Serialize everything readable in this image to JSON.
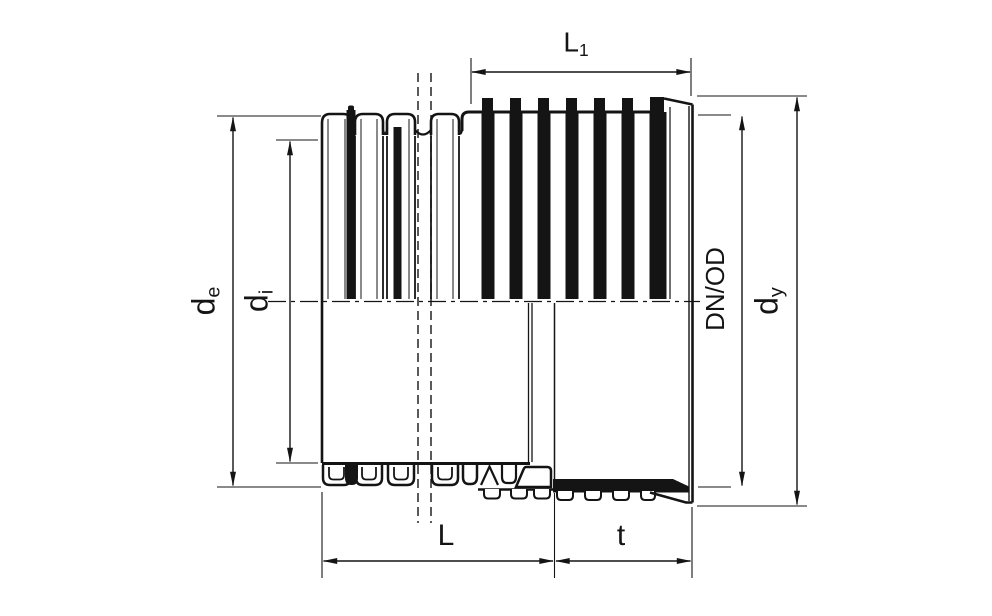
{
  "diagram": {
    "colors": {
      "background": "#ffffff",
      "line": "#141414"
    },
    "dimension_labels": {
      "l1": {
        "base": "L",
        "sub": "1"
      },
      "de": {
        "base": "d",
        "sub": "e"
      },
      "di": {
        "base": "d",
        "sub": "i"
      },
      "dn_od": {
        "text": "DN/OD"
      },
      "dy": {
        "base": "d",
        "sub": "y"
      },
      "l": {
        "text": "L"
      },
      "t": {
        "text": "t"
      }
    }
  }
}
